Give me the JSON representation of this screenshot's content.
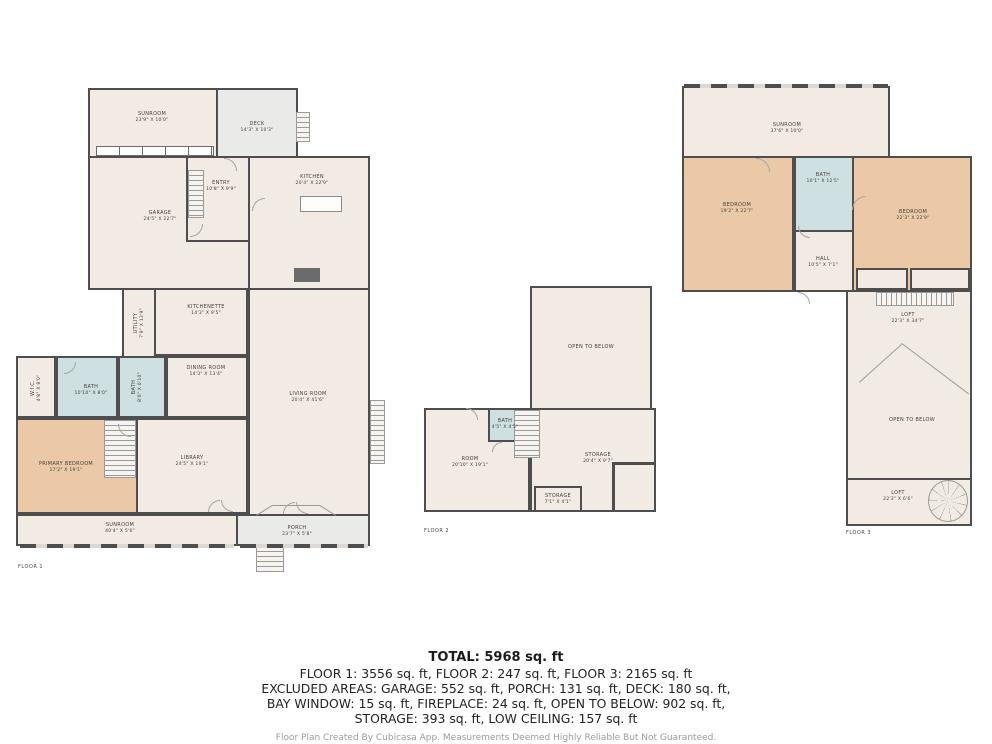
{
  "colors": {
    "room": "#f2ebe3",
    "outdoor": "#eaeae8",
    "bedroom": "#ecc9a6",
    "bath": "#cfe0e3",
    "wall": "#4f4e4e"
  },
  "floors": [
    {
      "caption": "FLOOR 1",
      "caption_x": 18,
      "caption_y": 564,
      "rooms": [
        {
          "id": "f1-sunroom-top",
          "name": "SUNROOM",
          "dims": "23'9\" X 10'0\"",
          "type": "room",
          "x": 88,
          "y": 88,
          "w": 130,
          "h": 70,
          "lx": 152,
          "ly": 117
        },
        {
          "id": "f1-deck",
          "name": "DECK",
          "dims": "14'3\" X 10'3\"",
          "type": "outdoor",
          "x": 216,
          "y": 88,
          "w": 82,
          "h": 72,
          "lx": 257,
          "ly": 127
        },
        {
          "id": "f1-garage",
          "name": "GARAGE",
          "dims": "24'5\" X 22'7\"",
          "type": "room",
          "x": 88,
          "y": 156,
          "w": 162,
          "h": 134,
          "lx": 160,
          "ly": 216
        },
        {
          "id": "f1-entry",
          "name": "ENTRY",
          "dims": "10'8\" X 9'9\"",
          "type": "room",
          "x": 186,
          "y": 156,
          "w": 64,
          "h": 86,
          "lx": 221,
          "ly": 186
        },
        {
          "id": "f1-kitchen",
          "name": "KITCHEN",
          "dims": "20'4\" X 22'9\"",
          "type": "room",
          "x": 248,
          "y": 156,
          "w": 122,
          "h": 134,
          "lx": 312,
          "ly": 180
        },
        {
          "id": "f1-living-room",
          "name": "LIVING ROOM",
          "dims": "20'4\" X 41'6\"",
          "type": "room",
          "x": 248,
          "y": 288,
          "w": 122,
          "h": 228,
          "lx": 308,
          "ly": 397
        },
        {
          "id": "f1-utility",
          "name": "UTILITY",
          "dims": "7'9\" X 13'9\"",
          "type": "room",
          "x": 122,
          "y": 288,
          "w": 34,
          "h": 70,
          "lx": 139,
          "ly": 323,
          "vert": true
        },
        {
          "id": "f1-kitchenette",
          "name": "KITCHENETTE",
          "dims": "14'3\" X 9'5\"",
          "type": "room",
          "x": 154,
          "y": 288,
          "w": 94,
          "h": 68,
          "lx": 206,
          "ly": 310
        },
        {
          "id": "f1-dining-room",
          "name": "DINING ROOM",
          "dims": "14'3\" X 13'4\"",
          "type": "room",
          "x": 166,
          "y": 356,
          "w": 82,
          "h": 62,
          "lx": 206,
          "ly": 371
        },
        {
          "id": "f1-bath-2",
          "name": "BATH",
          "dims": "8'0\" X 6'10\"",
          "type": "bath",
          "x": 118,
          "y": 356,
          "w": 48,
          "h": 62,
          "lx": 137,
          "ly": 387,
          "vert": true
        },
        {
          "id": "f1-bath-1",
          "name": "BATH",
          "dims": "10'10\" X 8'0\"",
          "type": "bath",
          "x": 56,
          "y": 356,
          "w": 62,
          "h": 62,
          "lx": 91,
          "ly": 390
        },
        {
          "id": "f1-wic",
          "name": "W.I.C.",
          "dims": "4'8\" X 8'0\"",
          "type": "room",
          "x": 16,
          "y": 356,
          "w": 40,
          "h": 62,
          "lx": 36,
          "ly": 388,
          "vert": true
        },
        {
          "id": "f1-primary-bedroom",
          "name": "PRIMARY BEDROOM",
          "dims": "17'2\" X 19'1\"",
          "type": "bedroom",
          "x": 16,
          "y": 418,
          "w": 122,
          "h": 96,
          "lx": 66,
          "ly": 467
        },
        {
          "id": "f1-library",
          "name": "LIBRARY",
          "dims": "24'5\" X 19'1\"",
          "type": "room",
          "x": 136,
          "y": 418,
          "w": 112,
          "h": 96,
          "lx": 192,
          "ly": 461
        },
        {
          "id": "f1-sunroom-bottom",
          "name": "SUNROOM",
          "dims": "40'4\" X 5'6\"",
          "type": "room",
          "x": 16,
          "y": 514,
          "w": 222,
          "h": 32,
          "lx": 120,
          "ly": 528
        },
        {
          "id": "f1-porch",
          "name": "PORCH",
          "dims": "23'7\" X 5'8\"",
          "type": "outdoor",
          "x": 236,
          "y": 514,
          "w": 134,
          "h": 32,
          "lx": 297,
          "ly": 531
        }
      ],
      "stairs": [
        {
          "x": 188,
          "y": 170,
          "w": 16,
          "h": 48,
          "dir": "v"
        },
        {
          "x": 104,
          "y": 420,
          "w": 32,
          "h": 58,
          "dir": "v"
        },
        {
          "x": 296,
          "y": 112,
          "w": 14,
          "h": 30,
          "dir": "v"
        },
        {
          "x": 256,
          "y": 546,
          "w": 28,
          "h": 26,
          "dir": "v"
        },
        {
          "x": 370,
          "y": 400,
          "w": 15,
          "h": 64,
          "dir": "v"
        }
      ],
      "windows": [
        {
          "x": 96,
          "y": 146,
          "w": 118,
          "h": 10,
          "kind": "boxes"
        },
        {
          "x": 20,
          "y": 544,
          "w": 214,
          "h": 4,
          "kind": "dash"
        },
        {
          "x": 240,
          "y": 544,
          "w": 128,
          "h": 4,
          "kind": "dash"
        }
      ],
      "fixtures": [
        {
          "id": "kitchen-island",
          "x": 300,
          "y": 196,
          "w": 42,
          "h": 16
        }
      ],
      "solids": [
        {
          "id": "fireplace",
          "x": 294,
          "y": 268,
          "w": 26,
          "h": 14
        }
      ],
      "lines": [
        {
          "x": 256,
          "y": 515,
          "len": 19,
          "rot": -32
        },
        {
          "x": 272,
          "y": 505,
          "len": 48,
          "rot": 0
        },
        {
          "x": 320,
          "y": 505,
          "len": 19,
          "rot": 32
        }
      ],
      "doors": [
        {
          "x": 224,
          "y": 158,
          "r": 13,
          "rot": 90
        },
        {
          "x": 190,
          "y": 224,
          "r": 13,
          "rot": 180
        },
        {
          "x": 252,
          "y": 198,
          "r": 13,
          "rot": 0
        },
        {
          "x": 118,
          "y": 424,
          "r": 13,
          "rot": 270
        },
        {
          "x": 64,
          "y": 362,
          "r": 12,
          "rot": 180
        },
        {
          "x": 208,
          "y": 500,
          "r": 12,
          "rot": 0
        },
        {
          "x": 221,
          "y": 500,
          "r": 12,
          "rot": 270
        },
        {
          "x": 283,
          "y": 502,
          "r": 12,
          "rot": 0
        },
        {
          "x": 296,
          "y": 502,
          "r": 12,
          "rot": 270
        }
      ]
    },
    {
      "caption": "FLOOR 2",
      "caption_x": 424,
      "caption_y": 528,
      "rooms": [
        {
          "id": "f2-open-to-below",
          "name": "OPEN TO BELOW",
          "type": "room",
          "x": 530,
          "y": 286,
          "w": 122,
          "h": 124,
          "lx": 591,
          "ly": 347
        },
        {
          "id": "f2-room",
          "name": "ROOM",
          "dims": "20'10\" X 19'1\"",
          "type": "room",
          "x": 424,
          "y": 408,
          "w": 106,
          "h": 104,
          "lx": 470,
          "ly": 462
        },
        {
          "id": "f2-storage",
          "name": "STORAGE",
          "dims": "20'4\" X 9'7\"",
          "type": "room",
          "x": 530,
          "y": 408,
          "w": 126,
          "h": 104,
          "lx": 598,
          "ly": 458
        },
        {
          "id": "f2-bath",
          "name": "BATH",
          "dims": "4'5\" X 4'5\"",
          "type": "bath",
          "x": 488,
          "y": 408,
          "w": 34,
          "h": 34,
          "lx": 505,
          "ly": 424
        },
        {
          "id": "f2-storage-small",
          "name": "STORAGE",
          "dims": "7'1\" X 4'1\"",
          "type": "room",
          "x": 534,
          "y": 486,
          "w": 48,
          "h": 26,
          "lx": 558,
          "ly": 499
        }
      ],
      "stairs": [
        {
          "x": 514,
          "y": 410,
          "w": 26,
          "h": 48,
          "dir": "v"
        }
      ],
      "walls": [
        {
          "x": 612,
          "y": 462,
          "w": 3,
          "h": 50
        },
        {
          "x": 612,
          "y": 462,
          "w": 44,
          "h": 3
        }
      ],
      "doors": [
        {
          "x": 466,
          "y": 408,
          "r": 12,
          "rot": 90
        },
        {
          "x": 492,
          "y": 442,
          "r": 10,
          "rot": 0
        }
      ]
    },
    {
      "caption": "FLOOR 3",
      "caption_x": 846,
      "caption_y": 530,
      "rooms": [
        {
          "id": "f3-sunroom",
          "name": "SUNROOM",
          "dims": "37'6\" X 10'0\"",
          "type": "room",
          "x": 682,
          "y": 86,
          "w": 208,
          "h": 72,
          "lx": 787,
          "ly": 128
        },
        {
          "id": "f3-bedroom-left",
          "name": "BEDROOM",
          "dims": "19'2\" X 22'7\"",
          "type": "bedroom",
          "x": 682,
          "y": 156,
          "w": 112,
          "h": 136,
          "lx": 737,
          "ly": 208
        },
        {
          "id": "f3-bath",
          "name": "BATH",
          "dims": "10'1\" X 12'5\"",
          "type": "bath",
          "x": 794,
          "y": 156,
          "w": 60,
          "h": 76,
          "lx": 823,
          "ly": 178
        },
        {
          "id": "f3-bedroom-right",
          "name": "BEDROOM",
          "dims": "22'3\" X 22'9\"",
          "type": "bedroom",
          "x": 852,
          "y": 156,
          "w": 120,
          "h": 136,
          "lx": 913,
          "ly": 215
        },
        {
          "id": "f3-hall",
          "name": "HALL",
          "dims": "10'5\" X 7'1\"",
          "type": "room",
          "x": 794,
          "y": 230,
          "w": 60,
          "h": 62,
          "lx": 823,
          "ly": 262
        },
        {
          "id": "f3-closet-1",
          "type": "room",
          "x": 856,
          "y": 268,
          "w": 52,
          "h": 22
        },
        {
          "id": "f3-closet-2",
          "type": "room",
          "x": 910,
          "y": 268,
          "w": 60,
          "h": 22
        },
        {
          "id": "f3-loft-upper",
          "name": "LOFT",
          "dims": "22'3\" X 34'7\"",
          "type": "room",
          "x": 846,
          "y": 290,
          "w": 126,
          "h": 190,
          "lx": 908,
          "ly": 318
        },
        {
          "id": "f3-open-to-below",
          "name": "OPEN TO BELOW",
          "lx": 912,
          "ly": 420
        },
        {
          "id": "f3-loft-lower",
          "name": "LOFT",
          "dims": "22'3\" X 6'6\"",
          "type": "room",
          "x": 846,
          "y": 478,
          "w": 126,
          "h": 48,
          "lx": 898,
          "ly": 496
        }
      ],
      "stairs": [
        {
          "x": 876,
          "y": 292,
          "w": 78,
          "h": 14,
          "dir": "h"
        }
      ],
      "windows": [
        {
          "x": 684,
          "y": 84,
          "w": 204,
          "h": 4,
          "kind": "dash"
        }
      ],
      "lines": [
        {
          "x": 859,
          "y": 382,
          "len": 58,
          "rot": -42
        },
        {
          "x": 902,
          "y": 343,
          "len": 84,
          "rot": 37
        }
      ],
      "doors": [
        {
          "x": 756,
          "y": 158,
          "r": 14,
          "rot": 90
        },
        {
          "x": 798,
          "y": 226,
          "r": 12,
          "rot": 270
        },
        {
          "x": 798,
          "y": 292,
          "r": 12,
          "rot": 90
        },
        {
          "x": 852,
          "y": 196,
          "r": 14,
          "rot": 0
        }
      ],
      "spiral": {
        "x": 928,
        "y": 480,
        "w": 40,
        "h": 42
      }
    }
  ],
  "summary": {
    "total": "TOTAL: 5968 sq. ft",
    "lines": [
      "FLOOR 1: 3556 sq. ft, FLOOR 2: 247 sq. ft, FLOOR 3: 2165 sq. ft",
      "EXCLUDED AREAS: GARAGE: 552 sq. ft, PORCH: 131 sq. ft, DECK: 180 sq. ft,",
      "BAY WINDOW: 15 sq. ft, FIREPLACE: 24 sq. ft, OPEN TO BELOW: 902 sq. ft,",
      "STORAGE: 393 sq. ft, LOW CEILING: 157 sq. ft"
    ],
    "footer": "Floor Plan Created By Cubicasa App. Measurements Deemed Highly Reliable But Not Guaranteed."
  }
}
